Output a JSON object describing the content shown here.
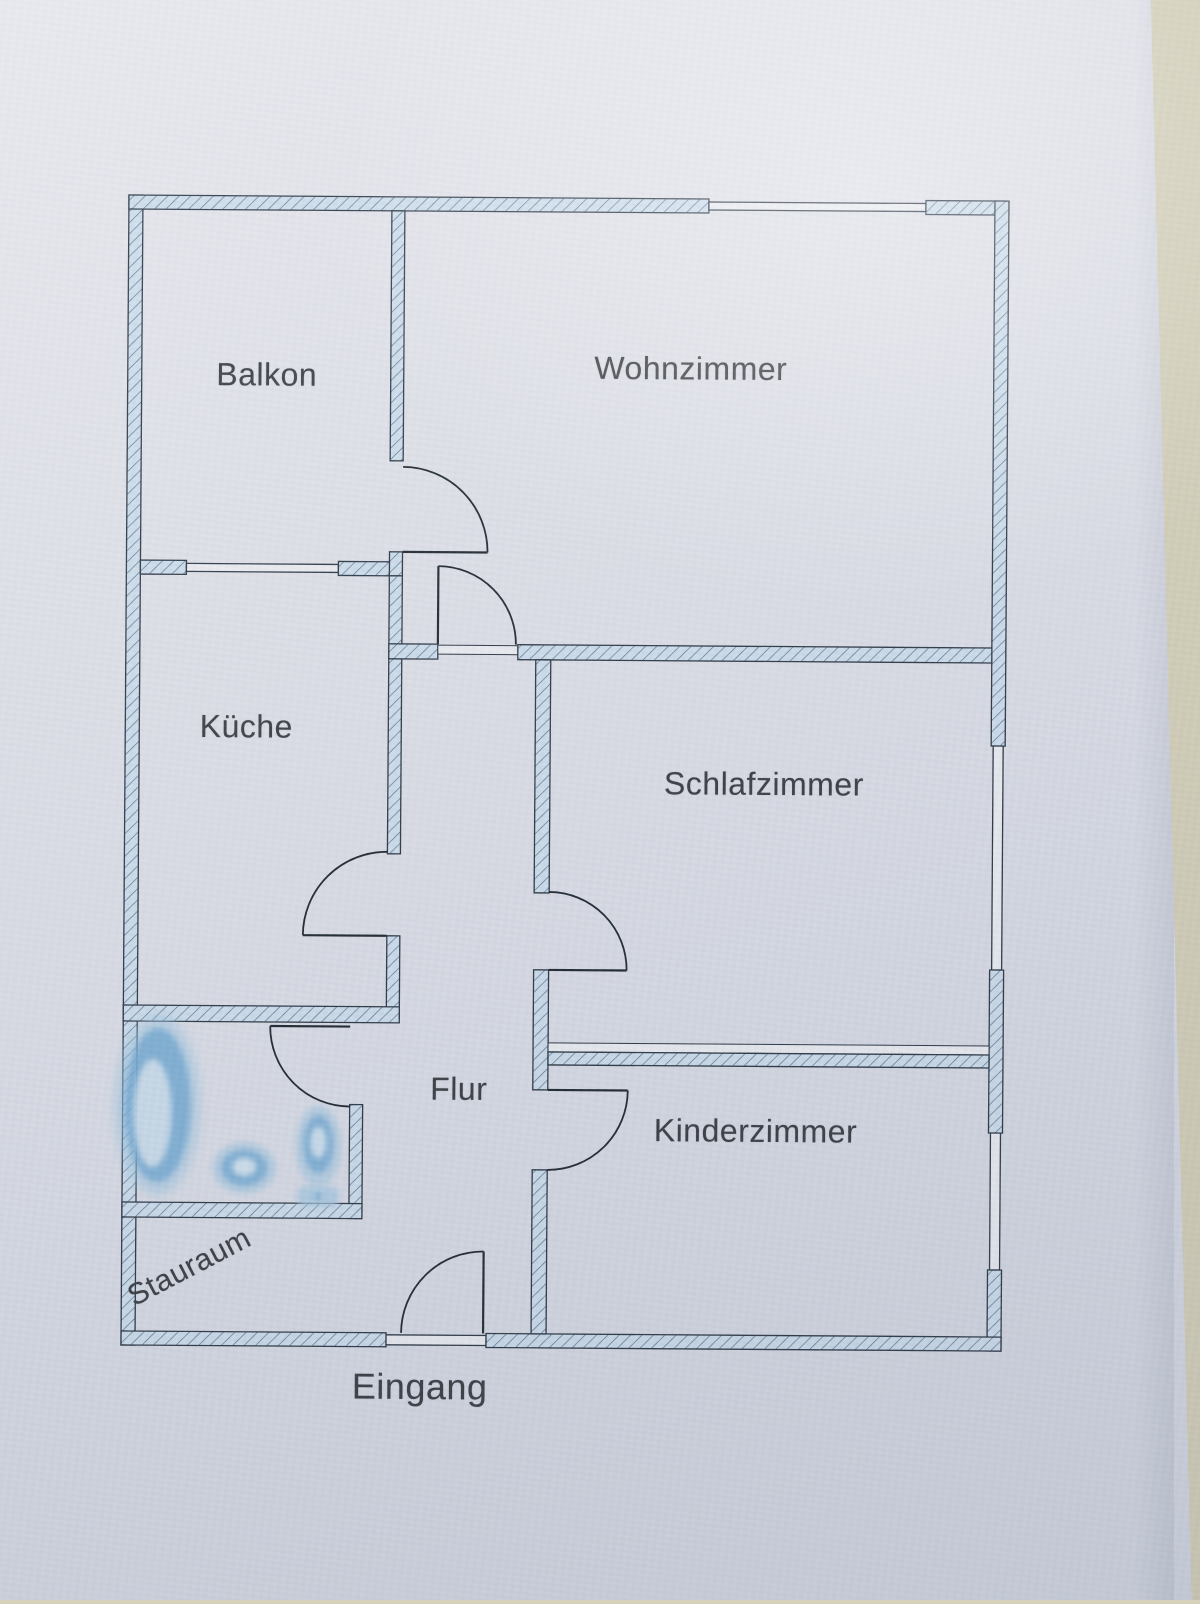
{
  "document": {
    "kind": "apartment floor plan (photographed printout)",
    "language": "de"
  },
  "rooms": [
    {
      "id": "balkon",
      "label": "Balkon"
    },
    {
      "id": "wohnzimmer",
      "label": "Wohnzimmer"
    },
    {
      "id": "kueche",
      "label": "Küche"
    },
    {
      "id": "schlafzimmer",
      "label": "Schlafzimmer"
    },
    {
      "id": "flur",
      "label": "Flur"
    },
    {
      "id": "kinderzimmer",
      "label": "Kinderzimmer"
    },
    {
      "id": "stauraum",
      "label": "Stauraum"
    }
  ],
  "entrance": {
    "label": "Eingang"
  },
  "fixtures": [
    {
      "name": "bathtub"
    },
    {
      "name": "washbasin"
    },
    {
      "name": "toilet"
    }
  ],
  "openings": {
    "door_count": 7,
    "window_count": 4
  },
  "colors": {
    "desk_background": "#d5d1ba",
    "paper": "#e2e4eb",
    "wall_fill": "#cfdfed",
    "wall_hatch_line": "#5b7691",
    "outline": "#2c3744",
    "label_text": "#3a3d42",
    "fixture_blue": "#79add4"
  }
}
